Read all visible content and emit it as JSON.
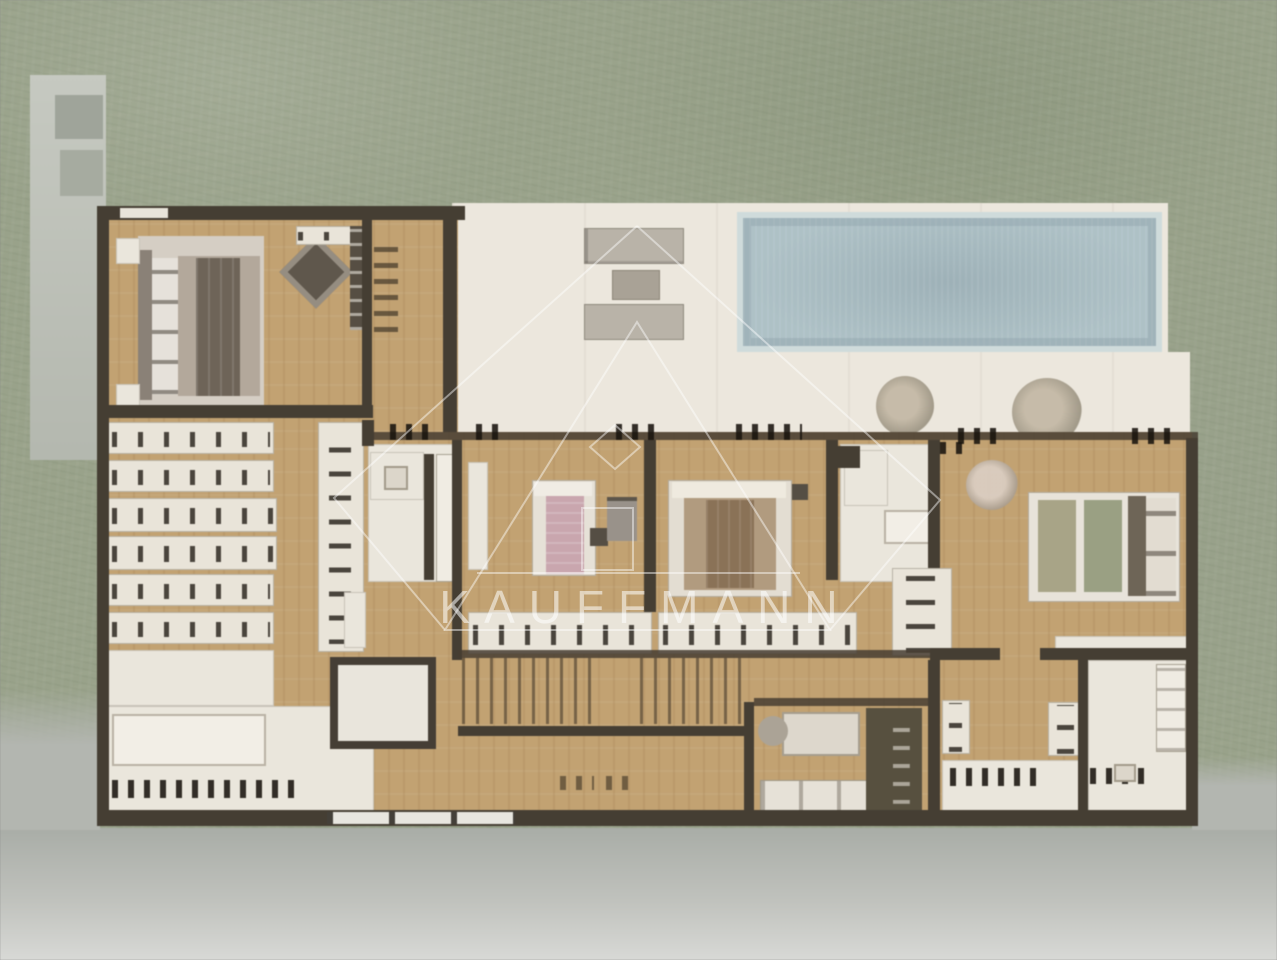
{
  "watermark": {
    "text": "KAUFFMANN"
  },
  "plan": {
    "type": "residential floor plan, top view, set in landscaped garden",
    "palette": {
      "vegetation_green": "#99a28a",
      "pavement_grey": "#b9bcb6",
      "wall_dark": "#453e33",
      "wood_floor": "#c2a272",
      "deck_white": "#ece7dd",
      "pool_water": "#aec1c6",
      "pool_rim": "#cfdbdb",
      "cabinet_white": "#e9e4d9",
      "bed_pink": "#c9a6ae",
      "bed_tan": "#b19b7f",
      "bed_olive": "#a2a286",
      "bed_grey": "#6e6458",
      "watermark": "#ffffff"
    },
    "areas": [
      "terrace deck",
      "swimming pool",
      "sun loungers",
      "master suite",
      "walk-in closet",
      "master bathroom",
      "bedroom with pink bed",
      "bedroom with tan bed",
      "bedroom with olive bed",
      "en-suite bathrooms",
      "staircase",
      "study nook",
      "laundry room",
      "entry"
    ]
  }
}
